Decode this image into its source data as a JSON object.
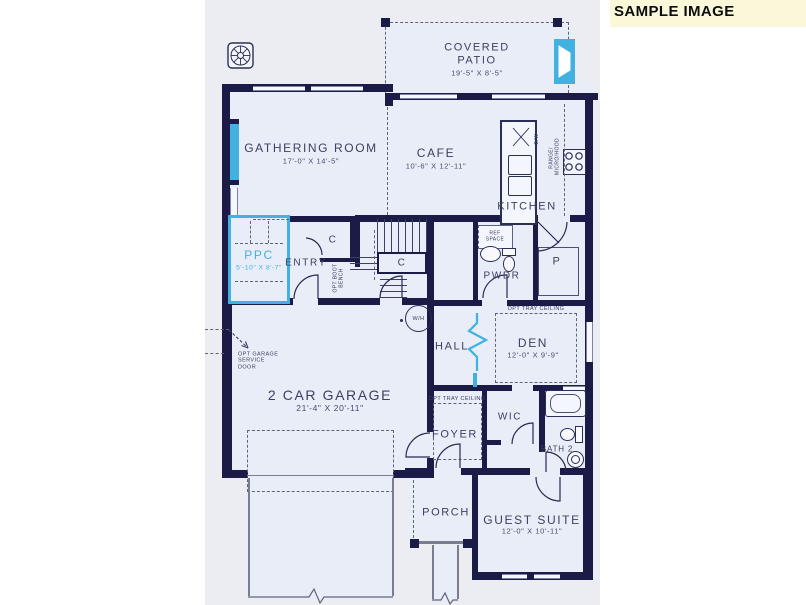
{
  "banner": {
    "label": "SAMPLE IMAGE"
  },
  "watermark": {
    "text": "© 2025"
  },
  "colors": {
    "wall": "#1b1b47",
    "room_fill": "#e8edf8",
    "plan_background": "#ecedf2",
    "accent_cyan": "#41b1e1",
    "banner_background": "#fbf8d9",
    "label_text": "#3b4161"
  },
  "rooms": {
    "covered_patio": {
      "name": "COVERED PATIO",
      "dims": "19'-5\" X 8'-5\""
    },
    "gathering_room": {
      "name": "GATHERING ROOM",
      "dims": "17'-0\" X 14'-5\""
    },
    "cafe": {
      "name": "CAFE",
      "dims": "10'-6\" X 12'-11\""
    },
    "kitchen": {
      "name": "KITCHEN"
    },
    "ppc": {
      "name": "PPC",
      "dims": "5'-10\" X 8'-7\""
    },
    "entry": {
      "name": "ENTRY"
    },
    "pwdr": {
      "name": "PWDR"
    },
    "pantry": {
      "name": "P"
    },
    "hall": {
      "name": "HALL"
    },
    "den": {
      "name": "DEN",
      "dims": "12'-0\" X 9'-9\""
    },
    "garage": {
      "name": "2 CAR GARAGE",
      "dims": "21'-4\" X 20'-11\""
    },
    "foyer": {
      "name": "FOYER"
    },
    "wic": {
      "name": "WIC"
    },
    "bath2": {
      "name": "BATH 2"
    },
    "porch": {
      "name": "PORCH"
    },
    "guest_suite": {
      "name": "GUEST SUITE",
      "dims": "12'-0\" X 10'-11\""
    }
  },
  "annotations": {
    "closet": "C",
    "ref_space": "REF SPACE",
    "range_micro_hood": "RANGE/ MICRO/HOOD",
    "dishwasher": "D/W",
    "water_heater": "W/H",
    "opt_boot_bench": "OPT BOOT BENCH",
    "opt_tray_ceiling": "OPT TRAY CEILING",
    "opt_garage_service_door": "OPT GARAGE SERVICE DOOR"
  }
}
